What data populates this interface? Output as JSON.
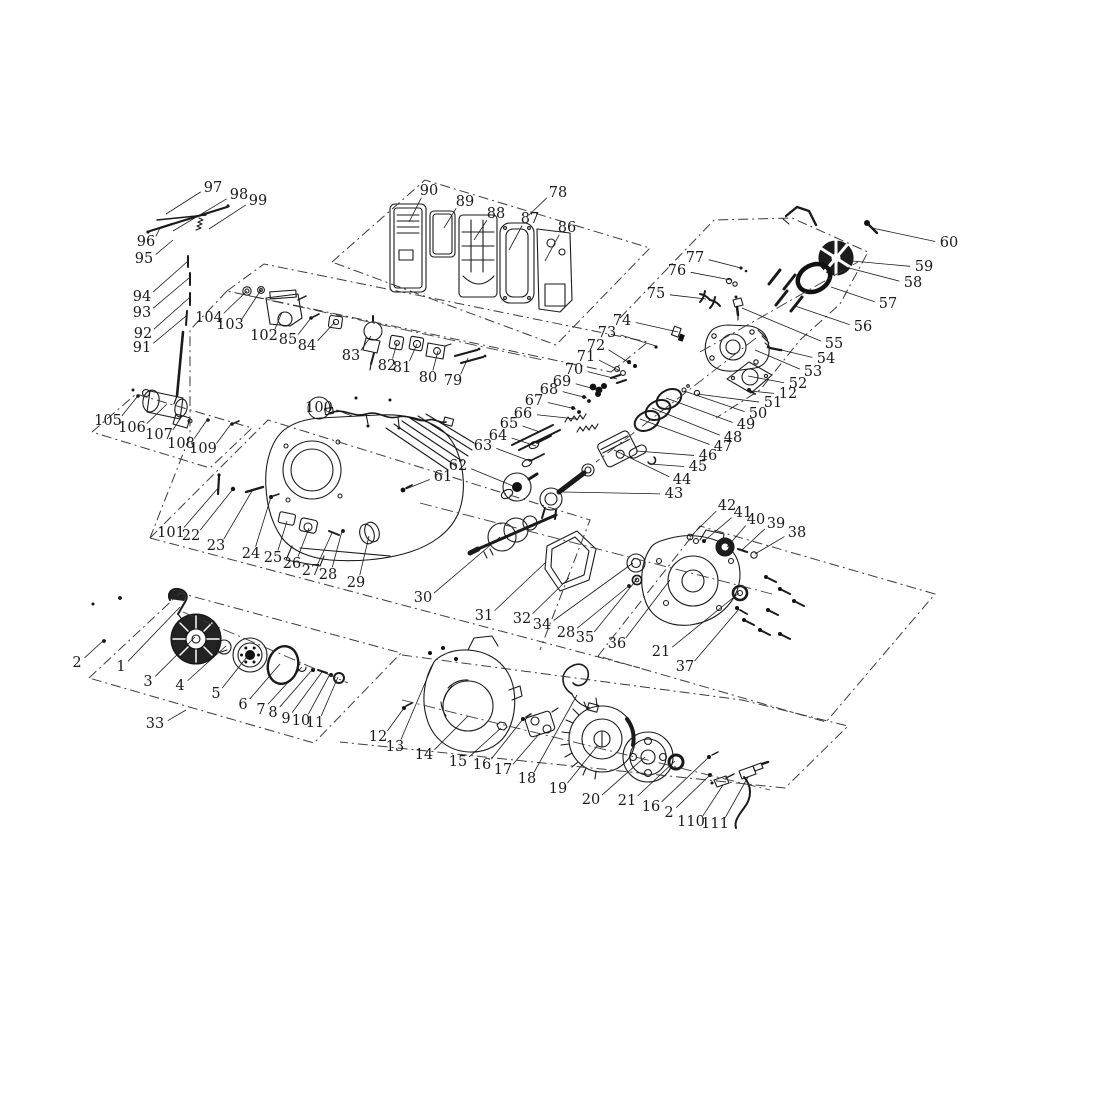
{
  "figure": {
    "kind": "exploded-parts-diagram",
    "subject": "small gasoline engine exploded view",
    "background": "#ffffff",
    "line_color": "#1a1a1a"
  },
  "callouts": [
    {
      "t": "1",
      "x": 121,
      "y": 667,
      "tx": 180,
      "ty": 607
    },
    {
      "t": "2",
      "x": 77,
      "y": 663,
      "tx": 104,
      "ty": 640
    },
    {
      "t": "3",
      "x": 148,
      "y": 682,
      "tx": 195,
      "ty": 637
    },
    {
      "t": "4",
      "x": 180,
      "y": 686,
      "tx": 226,
      "ty": 646
    },
    {
      "t": "5",
      "x": 216,
      "y": 694,
      "tx": 250,
      "ty": 653
    },
    {
      "t": "6",
      "x": 243,
      "y": 705,
      "tx": 280,
      "ty": 664
    },
    {
      "t": "7",
      "x": 261,
      "y": 710,
      "tx": 302,
      "ty": 667
    },
    {
      "t": "8",
      "x": 273,
      "y": 713,
      "tx": 312,
      "ty": 670
    },
    {
      "t": "9",
      "x": 286,
      "y": 719,
      "tx": 322,
      "ty": 672
    },
    {
      "t": "10",
      "x": 301,
      "y": 721,
      "tx": 330,
      "ty": 674
    },
    {
      "t": "11",
      "x": 315,
      "y": 723,
      "tx": 338,
      "ty": 677
    },
    {
      "t": "12",
      "x": 378,
      "y": 737,
      "tx": 404,
      "ty": 708
    },
    {
      "t": "13",
      "x": 395,
      "y": 747,
      "tx": 434,
      "ty": 662
    },
    {
      "t": "14",
      "x": 424,
      "y": 755,
      "tx": 468,
      "ty": 716
    },
    {
      "t": "15",
      "x": 458,
      "y": 762,
      "tx": 501,
      "ty": 728
    },
    {
      "t": "16",
      "x": 482,
      "y": 765,
      "tx": 523,
      "ty": 719
    },
    {
      "t": "17",
      "x": 503,
      "y": 770,
      "tx": 540,
      "ty": 733
    },
    {
      "t": "18",
      "x": 527,
      "y": 779,
      "tx": 577,
      "ty": 695
    },
    {
      "t": "19",
      "x": 558,
      "y": 789,
      "tx": 598,
      "ty": 745
    },
    {
      "t": "20",
      "x": 591,
      "y": 800,
      "tx": 645,
      "ty": 757
    },
    {
      "t": "21",
      "x": 627,
      "y": 801,
      "tx": 675,
      "ty": 761
    },
    {
      "t": "16",
      "x": 651,
      "y": 807,
      "tx": 709,
      "ty": 757
    },
    {
      "t": "2",
      "x": 669,
      "y": 813,
      "tx": 710,
      "ty": 775
    },
    {
      "t": "110",
      "x": 691,
      "y": 822,
      "tx": 723,
      "ty": 785
    },
    {
      "t": "111",
      "x": 715,
      "y": 824,
      "tx": 748,
      "ty": 777
    },
    {
      "t": "22",
      "x": 191,
      "y": 536,
      "tx": 233,
      "ty": 489
    },
    {
      "t": "23",
      "x": 216,
      "y": 546,
      "tx": 252,
      "ty": 491
    },
    {
      "t": "24",
      "x": 251,
      "y": 554,
      "tx": 271,
      "ty": 497
    },
    {
      "t": "25",
      "x": 273,
      "y": 558,
      "tx": 287,
      "ty": 521
    },
    {
      "t": "26",
      "x": 292,
      "y": 564,
      "tx": 309,
      "ty": 528
    },
    {
      "t": "27",
      "x": 311,
      "y": 571,
      "tx": 332,
      "ty": 533
    },
    {
      "t": "28",
      "x": 328,
      "y": 575,
      "tx": 342,
      "ty": 531
    },
    {
      "t": "29",
      "x": 356,
      "y": 583,
      "tx": 369,
      "ty": 536
    },
    {
      "t": "30",
      "x": 423,
      "y": 598,
      "tx": 500,
      "ty": 537
    },
    {
      "t": "31",
      "x": 484,
      "y": 616,
      "tx": 546,
      "ty": 562
    },
    {
      "t": "32",
      "x": 522,
      "y": 619,
      "tx": 569,
      "ty": 578
    },
    {
      "t": "33",
      "x": 155,
      "y": 724,
      "tx": 186,
      "ty": 710
    },
    {
      "t": "34",
      "x": 542,
      "y": 625,
      "tx": 633,
      "ty": 563
    },
    {
      "t": "28",
      "x": 566,
      "y": 633,
      "tx": 630,
      "ty": 585
    },
    {
      "t": "35",
      "x": 585,
      "y": 638,
      "tx": 637,
      "ty": 579
    },
    {
      "t": "36",
      "x": 617,
      "y": 644,
      "tx": 670,
      "ty": 580
    },
    {
      "t": "21",
      "x": 661,
      "y": 652,
      "tx": 739,
      "ty": 593
    },
    {
      "t": "37",
      "x": 685,
      "y": 667,
      "tx": 739,
      "ty": 609
    },
    {
      "t": "38",
      "x": 797,
      "y": 533,
      "tx": 755,
      "ty": 554
    },
    {
      "t": "39",
      "x": 776,
      "y": 524,
      "tx": 742,
      "ty": 550
    },
    {
      "t": "40",
      "x": 756,
      "y": 520,
      "tx": 727,
      "ty": 547
    },
    {
      "t": "41",
      "x": 743,
      "y": 513,
      "tx": 704,
      "ty": 541
    },
    {
      "t": "42",
      "x": 727,
      "y": 506,
      "tx": 690,
      "ty": 537
    },
    {
      "t": "43",
      "x": 674,
      "y": 494,
      "tx": 563,
      "ty": 492
    },
    {
      "t": "44",
      "x": 682,
      "y": 480,
      "tx": 614,
      "ty": 450
    },
    {
      "t": "45",
      "x": 698,
      "y": 467,
      "tx": 650,
      "ty": 464
    },
    {
      "t": "46",
      "x": 708,
      "y": 456,
      "tx": 636,
      "ty": 451
    },
    {
      "t": "47",
      "x": 723,
      "y": 447,
      "tx": 640,
      "ty": 419
    },
    {
      "t": "48",
      "x": 733,
      "y": 438,
      "tx": 652,
      "ty": 408
    },
    {
      "t": "49",
      "x": 746,
      "y": 425,
      "tx": 666,
      "ty": 398
    },
    {
      "t": "50",
      "x": 758,
      "y": 414,
      "tx": 684,
      "ty": 391
    },
    {
      "t": "51",
      "x": 773,
      "y": 403,
      "tx": 697,
      "ty": 394
    },
    {
      "t": "12",
      "x": 788,
      "y": 394,
      "tx": 750,
      "ty": 391
    },
    {
      "t": "52",
      "x": 798,
      "y": 384,
      "tx": 748,
      "ty": 376
    },
    {
      "t": "53",
      "x": 813,
      "y": 372,
      "tx": 755,
      "ty": 350
    },
    {
      "t": "54",
      "x": 826,
      "y": 359,
      "tx": 777,
      "ty": 349
    },
    {
      "t": "55",
      "x": 834,
      "y": 344,
      "tx": 742,
      "ty": 308
    },
    {
      "t": "56",
      "x": 863,
      "y": 327,
      "tx": 795,
      "ty": 306
    },
    {
      "t": "57",
      "x": 888,
      "y": 304,
      "tx": 831,
      "ty": 287
    },
    {
      "t": "58",
      "x": 913,
      "y": 283,
      "tx": 849,
      "ty": 268
    },
    {
      "t": "59",
      "x": 924,
      "y": 267,
      "tx": 852,
      "ty": 261
    },
    {
      "t": "60",
      "x": 949,
      "y": 243,
      "tx": 872,
      "ty": 228
    },
    {
      "t": "61",
      "x": 443,
      "y": 477,
      "tx": 406,
      "ty": 489
    },
    {
      "t": "62",
      "x": 458,
      "y": 466,
      "tx": 513,
      "ty": 486
    },
    {
      "t": "63",
      "x": 483,
      "y": 446,
      "tx": 530,
      "ty": 461
    },
    {
      "t": "64",
      "x": 498,
      "y": 436,
      "tx": 536,
      "ty": 446
    },
    {
      "t": "65",
      "x": 509,
      "y": 424,
      "tx": 540,
      "ty": 432
    },
    {
      "t": "66",
      "x": 523,
      "y": 414,
      "tx": 576,
      "ty": 419
    },
    {
      "t": "67",
      "x": 534,
      "y": 401,
      "tx": 576,
      "ty": 409
    },
    {
      "t": "68",
      "x": 549,
      "y": 390,
      "tx": 587,
      "ty": 398
    },
    {
      "t": "69",
      "x": 562,
      "y": 382,
      "tx": 598,
      "ty": 390
    },
    {
      "t": "70",
      "x": 574,
      "y": 370,
      "tx": 617,
      "ty": 379
    },
    {
      "t": "71",
      "x": 586,
      "y": 357,
      "tx": 620,
      "ty": 371
    },
    {
      "t": "72",
      "x": 596,
      "y": 346,
      "tx": 631,
      "ty": 364
    },
    {
      "t": "73",
      "x": 607,
      "y": 333,
      "tx": 656,
      "ty": 346
    },
    {
      "t": "74",
      "x": 622,
      "y": 321,
      "tx": 678,
      "ty": 332
    },
    {
      "t": "75",
      "x": 656,
      "y": 294,
      "tx": 706,
      "ty": 299
    },
    {
      "t": "76",
      "x": 677,
      "y": 271,
      "tx": 731,
      "ty": 280
    },
    {
      "t": "77",
      "x": 695,
      "y": 258,
      "tx": 741,
      "ty": 268
    },
    {
      "t": "78",
      "x": 558,
      "y": 193,
      "tx": 529,
      "ty": 215
    },
    {
      "t": "79",
      "x": 453,
      "y": 381,
      "tx": 468,
      "ty": 358
    },
    {
      "t": "80",
      "x": 428,
      "y": 378,
      "tx": 438,
      "ty": 351
    },
    {
      "t": "81",
      "x": 402,
      "y": 368,
      "tx": 417,
      "ty": 344
    },
    {
      "t": "82",
      "x": 387,
      "y": 366,
      "tx": 397,
      "ty": 343
    },
    {
      "t": "83",
      "x": 351,
      "y": 356,
      "tx": 371,
      "ty": 336
    },
    {
      "t": "84",
      "x": 307,
      "y": 346,
      "tx": 335,
      "ty": 322
    },
    {
      "t": "85",
      "x": 288,
      "y": 340,
      "tx": 311,
      "ty": 318
    },
    {
      "t": "86",
      "x": 567,
      "y": 228,
      "tx": 545,
      "ty": 261
    },
    {
      "t": "87",
      "x": 530,
      "y": 219,
      "tx": 509,
      "ty": 250
    },
    {
      "t": "88",
      "x": 496,
      "y": 214,
      "tx": 474,
      "ty": 240
    },
    {
      "t": "89",
      "x": 465,
      "y": 202,
      "tx": 444,
      "ty": 228
    },
    {
      "t": "90",
      "x": 429,
      "y": 191,
      "tx": 409,
      "ty": 222
    },
    {
      "t": "91",
      "x": 142,
      "y": 348,
      "tx": 186,
      "ty": 316
    },
    {
      "t": "92",
      "x": 143,
      "y": 334,
      "tx": 189,
      "ty": 298
    },
    {
      "t": "93",
      "x": 142,
      "y": 313,
      "tx": 189,
      "ty": 278
    },
    {
      "t": "94",
      "x": 142,
      "y": 297,
      "tx": 188,
      "ty": 261
    },
    {
      "t": "95",
      "x": 144,
      "y": 259,
      "tx": 173,
      "ty": 240
    },
    {
      "t": "96",
      "x": 146,
      "y": 242,
      "tx": 160,
      "ty": 228
    },
    {
      "t": "97",
      "x": 213,
      "y": 188,
      "tx": 166,
      "ty": 214
    },
    {
      "t": "98",
      "x": 239,
      "y": 195,
      "tx": 173,
      "ty": 231
    },
    {
      "t": "99",
      "x": 258,
      "y": 201,
      "tx": 209,
      "ty": 229
    },
    {
      "t": "100",
      "x": 319,
      "y": 408,
      "tx": 352,
      "ty": 416,
      "circled": true
    },
    {
      "t": "101",
      "x": 171,
      "y": 533,
      "tx": 219,
      "ty": 487
    },
    {
      "t": "102",
      "x": 264,
      "y": 336,
      "tx": 282,
      "ty": 312
    },
    {
      "t": "103",
      "x": 230,
      "y": 325,
      "tx": 261,
      "ty": 290
    },
    {
      "t": "104",
      "x": 209,
      "y": 318,
      "tx": 247,
      "ty": 291
    },
    {
      "t": "105",
      "x": 108,
      "y": 421,
      "tx": 137,
      "ty": 397
    },
    {
      "t": "106",
      "x": 132,
      "y": 428,
      "tx": 167,
      "ty": 404
    },
    {
      "t": "107",
      "x": 159,
      "y": 435,
      "tx": 182,
      "ty": 416
    },
    {
      "t": "108",
      "x": 181,
      "y": 444,
      "tx": 207,
      "ty": 420
    },
    {
      "t": "109",
      "x": 203,
      "y": 449,
      "tx": 231,
      "ty": 424
    }
  ],
  "chain_lines": [
    {
      "name": "air-cleaner-group-boundary",
      "points": [
        [
          332,
          262
        ],
        [
          425,
          180
        ],
        [
          650,
          248
        ],
        [
          556,
          345
        ],
        [
          332,
          262
        ]
      ]
    },
    {
      "name": "carburetor-group-boundary",
      "points": [
        [
          227,
          291
        ],
        [
          264,
          264
        ],
        [
          648,
          342
        ],
        [
          611,
          372
        ],
        [
          227,
          291
        ]
      ]
    },
    {
      "name": "cylinder-head-group-boundary",
      "points": [
        [
          620,
          318
        ],
        [
          714,
          220
        ],
        [
          792,
          218
        ],
        [
          868,
          252
        ],
        [
          840,
          304
        ],
        [
          800,
          340
        ],
        [
          760,
          390
        ],
        [
          716,
          418
        ]
      ]
    },
    {
      "name": "starter-motor-group-boundary",
      "points": [
        [
          92,
          432
        ],
        [
          136,
          394
        ],
        [
          252,
          428
        ],
        [
          210,
          468
        ],
        [
          92,
          432
        ]
      ]
    },
    {
      "name": "recoil-starter-group-boundary",
      "points": [
        [
          89,
          678
        ],
        [
          180,
          593
        ],
        [
          401,
          653
        ],
        [
          314,
          743
        ],
        [
          89,
          678
        ]
      ]
    },
    {
      "name": "crankcase-group-boundary",
      "points": [
        [
          150,
          538
        ],
        [
          268,
          420
        ],
        [
          590,
          520
        ],
        [
          540,
          650
        ]
      ]
    },
    {
      "name": "crankcase-lower-edge",
      "points": [
        [
          150,
          538
        ],
        [
          640,
          668
        ]
      ]
    },
    {
      "name": "left-riser",
      "points": [
        [
          227,
          291
        ],
        [
          190,
          330
        ],
        [
          190,
          436
        ],
        [
          150,
          538
        ]
      ]
    },
    {
      "name": "cover-group-boundary",
      "points": [
        [
          598,
          656
        ],
        [
          700,
          526
        ],
        [
          935,
          594
        ],
        [
          826,
          722
        ],
        [
          598,
          656
        ]
      ]
    },
    {
      "name": "flywheel-group-boundary",
      "points": [
        [
          402,
          655
        ],
        [
          742,
          700
        ],
        [
          848,
          726
        ],
        [
          785,
          788
        ],
        [
          340,
          742
        ]
      ]
    },
    {
      "name": "carburetor-axis",
      "points": [
        [
          250,
          296
        ],
        [
          543,
          360
        ]
      ],
      "axis": true
    },
    {
      "name": "head-axis",
      "points": [
        [
          700,
          352
        ],
        [
          858,
          262
        ]
      ],
      "axis": true
    },
    {
      "name": "recoil-axis",
      "points": [
        [
          183,
          612
        ],
        [
          348,
          683
        ]
      ],
      "axis": true
    },
    {
      "name": "flywheel-axis",
      "points": [
        [
          402,
          700
        ],
        [
          770,
          790
        ]
      ],
      "axis": true
    },
    {
      "name": "crank-axis",
      "points": [
        [
          420,
          503
        ],
        [
          772,
          594
        ]
      ],
      "axis": true
    },
    {
      "name": "piston-axis",
      "points": [
        [
          756,
          338
        ],
        [
          596,
          462
        ]
      ],
      "axis": true
    }
  ]
}
